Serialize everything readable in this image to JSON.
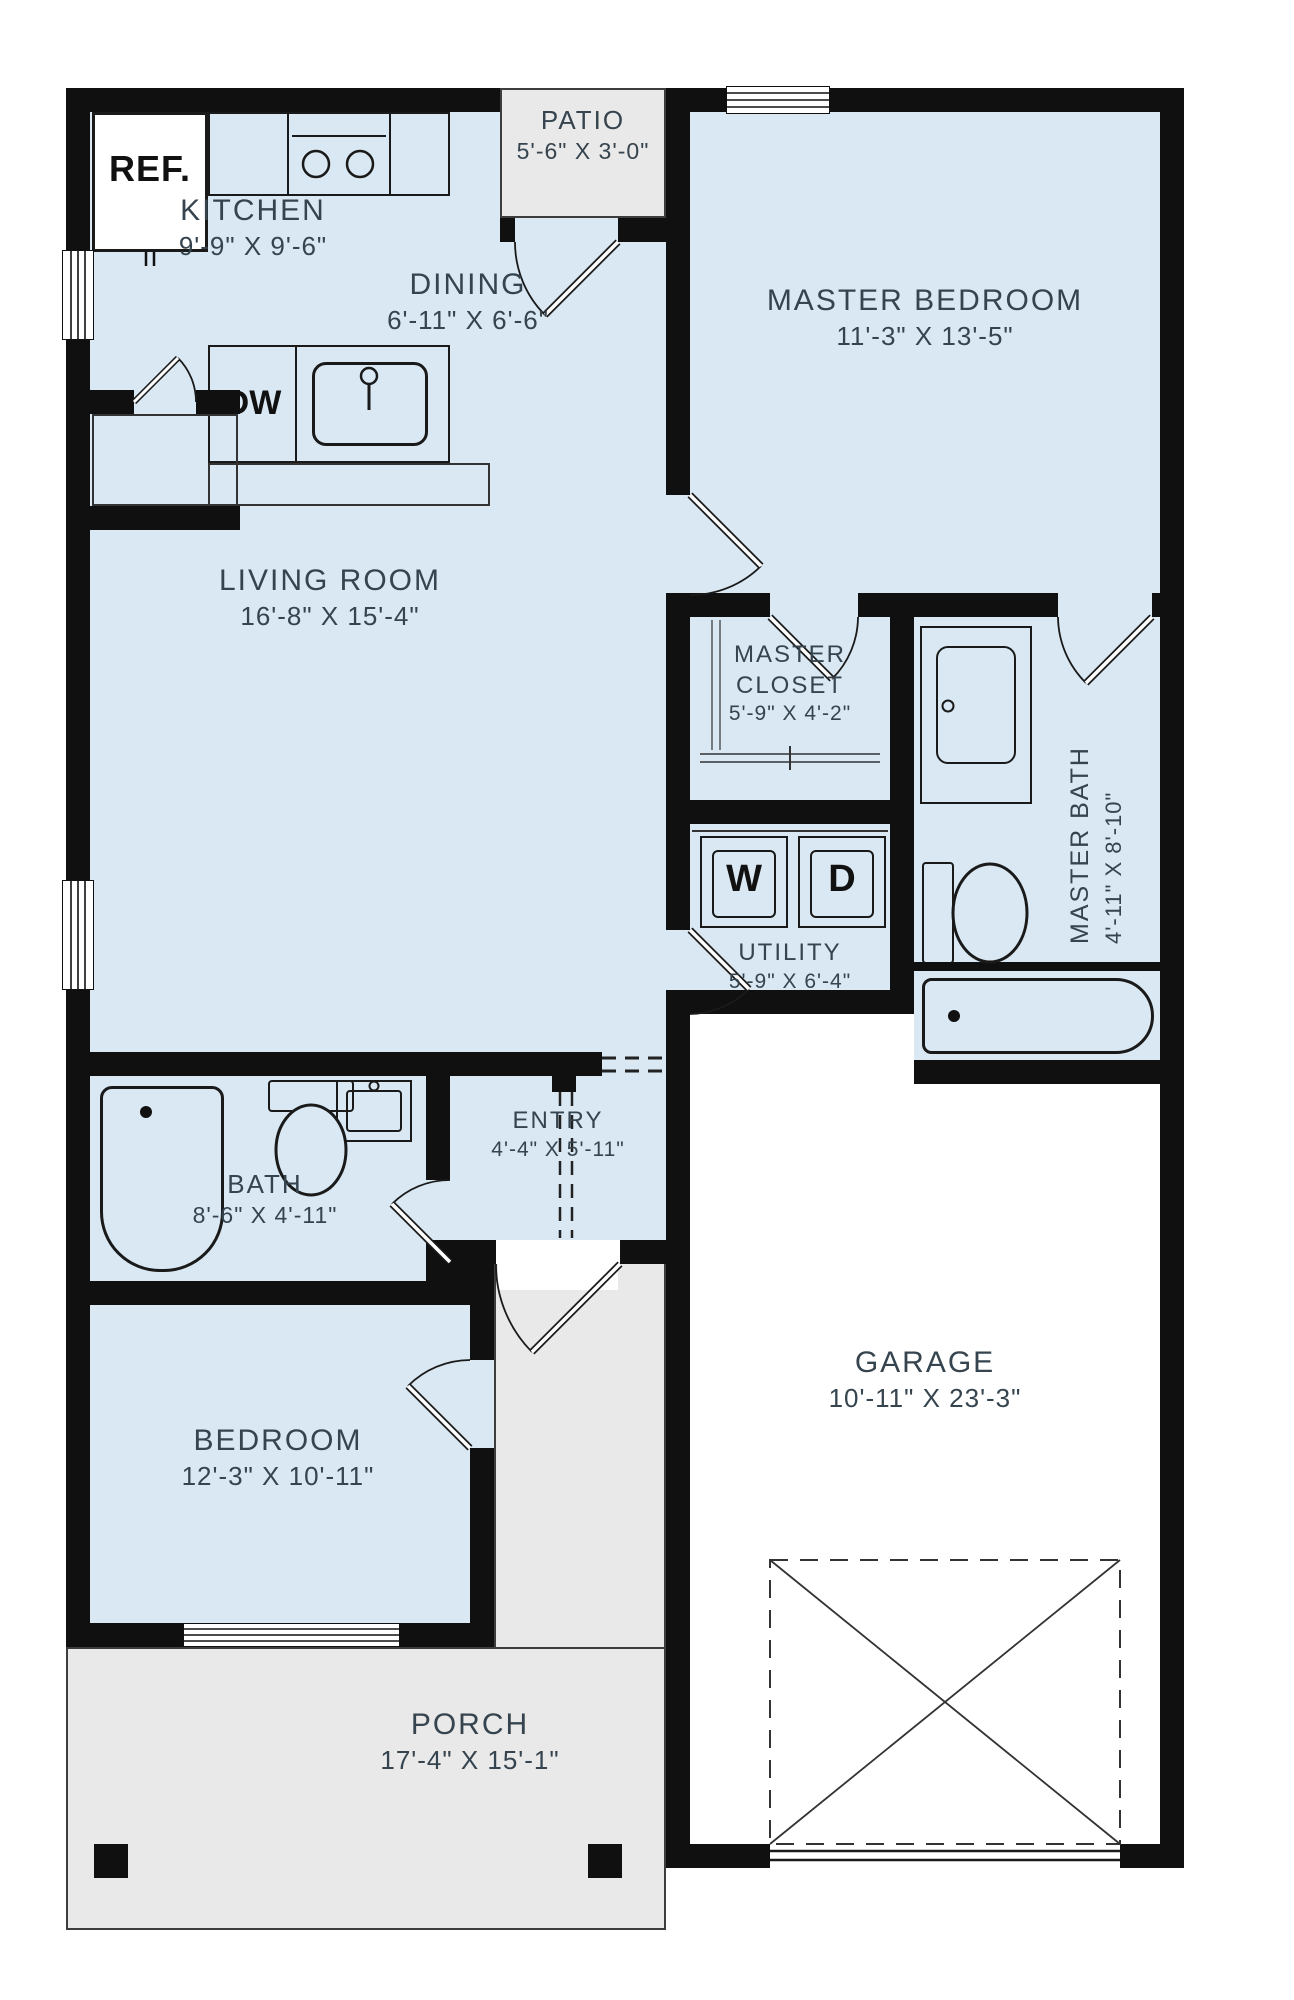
{
  "plan": {
    "colors": {
      "floor": "#d9e8f2",
      "outdoor": "#e9e9e9",
      "wall": "#101010",
      "text": "#35444e",
      "garage_floor": "#ffffff"
    },
    "rooms": {
      "patio": {
        "name": "PATIO",
        "dims": "5'-6\" X 3'-0\""
      },
      "kitchen": {
        "name": "KITCHEN",
        "dims": "9'-9\" X 9'-6\""
      },
      "dining": {
        "name": "DINING",
        "dims": "6'-11\" X 6'-6\""
      },
      "master_bedroom": {
        "name": "MASTER BEDROOM",
        "dims": "11'-3\" X 13'-5\""
      },
      "living_room": {
        "name": "LIVING ROOM",
        "dims": "16'-8\" X 15'-4\""
      },
      "master_closet": {
        "name": "MASTER CLOSET",
        "dims": "5'-9\" X 4'-2\""
      },
      "master_bath": {
        "name": "MASTER BATH",
        "dims": "4'-11\" X 8'-10\""
      },
      "utility": {
        "name": "UTILITY",
        "dims": "5'-9\" X 6'-4\""
      },
      "entry": {
        "name": "ENTRY",
        "dims": "4'-4\" X 5'-11\""
      },
      "bath": {
        "name": "BATH",
        "dims": "8'-6\" X 4'-11\""
      },
      "bedroom": {
        "name": "BEDROOM",
        "dims": "12'-3\" X 10'-11\""
      },
      "garage": {
        "name": "GARAGE",
        "dims": "10'-11\" X 23'-3\""
      },
      "porch": {
        "name": "PORCH",
        "dims": "17'-4\" X 15'-1\""
      }
    },
    "appliances": {
      "refrigerator": "REF.",
      "dishwasher": "DW",
      "washer": "W",
      "dryer": "D"
    }
  }
}
